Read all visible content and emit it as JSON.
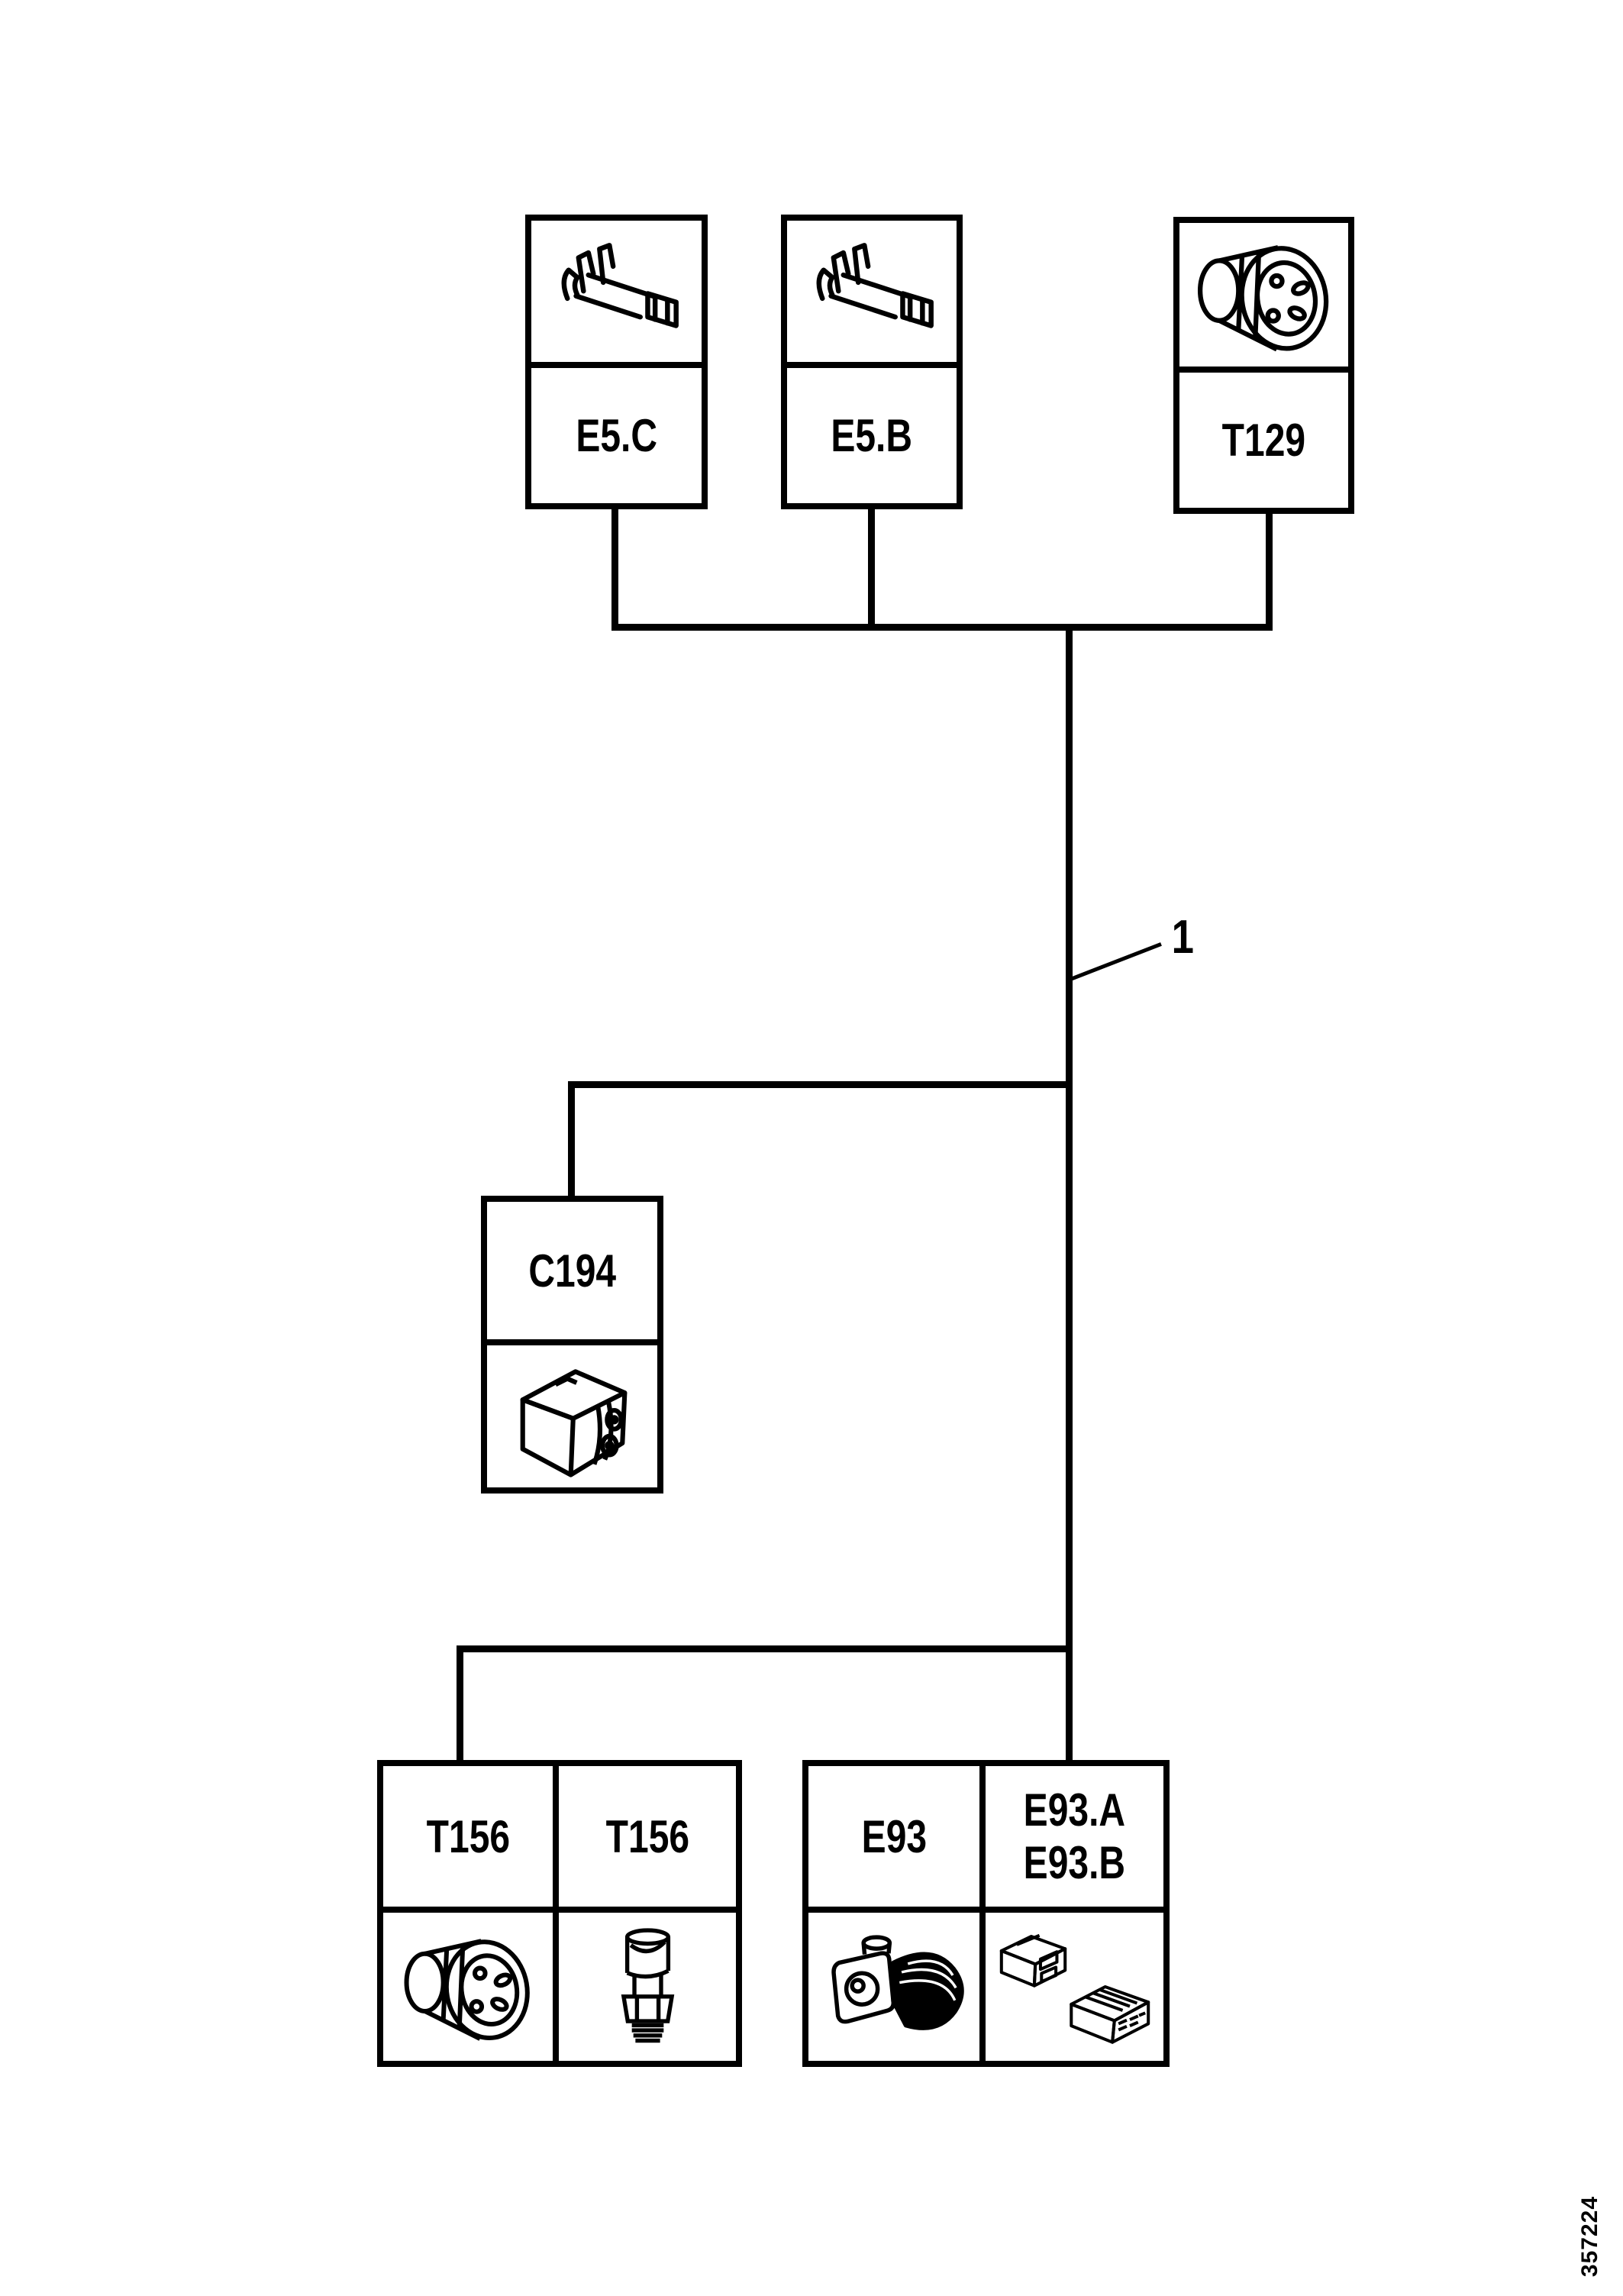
{
  "page": {
    "type": "wiring-harness-overview-diagram",
    "paper_color": "#ffffff",
    "ink_color": "#000000"
  },
  "callout": {
    "number": "1"
  },
  "figure_number": "357224",
  "boxes": {
    "e5c": {
      "label": "E5.C",
      "icon": "crimp-terminal-icon"
    },
    "e5b": {
      "label": "E5.B",
      "icon": "crimp-terminal-icon"
    },
    "t129": {
      "label": "T129",
      "icon": "round-connector-icon"
    },
    "c194": {
      "label": "C194",
      "icon": "relay-housing-icon"
    },
    "t156_left": {
      "label": "T156",
      "icon": "round-connector-icon"
    },
    "t156_right": {
      "label": "T156",
      "icon": "pressure-sensor-icon"
    },
    "e93": {
      "label": "E93",
      "icon": "heater-motor-icon"
    },
    "e93ab": {
      "label_line1": "E93.A",
      "label_line2": "E93.B",
      "icon": "connector-housings-icon"
    }
  }
}
